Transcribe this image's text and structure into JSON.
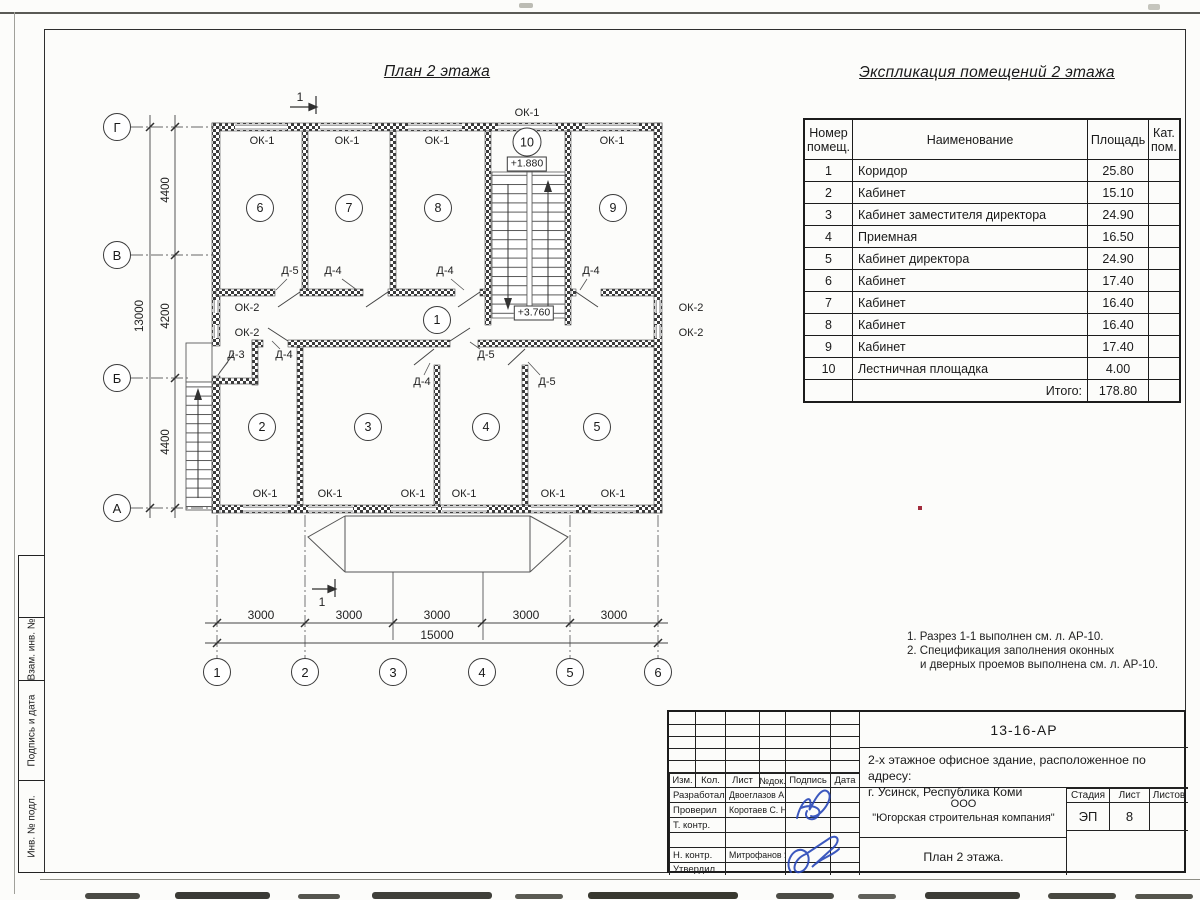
{
  "plan": {
    "title": "План 2 этажа",
    "window_ok1": "ОК-1",
    "window_ok2": "ОК-2",
    "door_d3": "Д-3",
    "door_d4": "Д-4",
    "door_d5": "Д-5",
    "level_stair": "+1.880",
    "level_corridor": "+3.760",
    "section_mark": "1",
    "rooms": [
      "1",
      "2",
      "3",
      "4",
      "5",
      "6",
      "7",
      "8",
      "9",
      "10"
    ],
    "axes_cols": [
      "1",
      "2",
      "3",
      "4",
      "5",
      "6"
    ],
    "axes_rows": [
      "Г",
      "В",
      "Б",
      "А"
    ],
    "dim_3000": "3000",
    "dim_15000": "15000",
    "dim_4400": "4400",
    "dim_4200": "4200",
    "dim_13000": "13000"
  },
  "explication": {
    "title": "Экспликация помещений 2 этажа",
    "col_num_l1": "Номер",
    "col_num_l2": "помещ.",
    "col_name": "Наименование",
    "col_area": "Площадь",
    "col_cat_l1": "Кат.",
    "col_cat_l2": "пом.",
    "rows": [
      {
        "n": "1",
        "name": "Коридор",
        "area": "25.80"
      },
      {
        "n": "2",
        "name": "Кабинет",
        "area": "15.10"
      },
      {
        "n": "3",
        "name": "Кабинет заместителя директора",
        "area": "24.90"
      },
      {
        "n": "4",
        "name": "Приемная",
        "area": "16.50"
      },
      {
        "n": "5",
        "name": "Кабинет директора",
        "area": "24.90"
      },
      {
        "n": "6",
        "name": "Кабинет",
        "area": "17.40"
      },
      {
        "n": "7",
        "name": "Кабинет",
        "area": "16.40"
      },
      {
        "n": "8",
        "name": "Кабинет",
        "area": "16.40"
      },
      {
        "n": "9",
        "name": "Кабинет",
        "area": "17.40"
      },
      {
        "n": "10",
        "name": "Лестничная площадка",
        "area": "4.00"
      }
    ],
    "total_label": "Итого:",
    "total_value": "178.80"
  },
  "notes": {
    "n1": "1. Разрез 1-1 выполнен см. л. АР-10.",
    "n2": "2. Спецификация заполнения оконных",
    "n3": "и дверных проемов выполнена см. л. АР-10."
  },
  "titleblock": {
    "doc_number": "13-16-АР",
    "object_line1": "2-х этажное офисное здание, расположенное по адресу:",
    "object_line2": "г. Усинск, Республика Коми",
    "org_line1": "ООО",
    "org_line2": "\"Югорская строительная компания\"",
    "sheet_title": "План 2 этажа.",
    "col_izm": "Изм.",
    "col_kol": "Кол.",
    "col_list": "Лист",
    "col_ndoc": "№док.",
    "col_podpis": "Подпись",
    "col_data": "Дата",
    "stage_header": "Стадия",
    "sheet_header": "Лист",
    "sheets_header": "Листов",
    "stage_value": "ЭП",
    "sheet_value": "8",
    "role_developed": "Разработал",
    "role_checked": "Проверил",
    "role_tcontrol": "Т. контр.",
    "role_ncontrol": "Н. контр.",
    "role_approved": "Утвердил",
    "name_developed": "Двоеглазов А. В.",
    "name_checked": "Коротаев С. Н.",
    "name_ncontrol": "Митрофанов Я. А."
  },
  "side_stamp": {
    "vzam": "Взам. инв. №",
    "podpis": "Подпись и дата",
    "inv": "Инв. № подл."
  }
}
